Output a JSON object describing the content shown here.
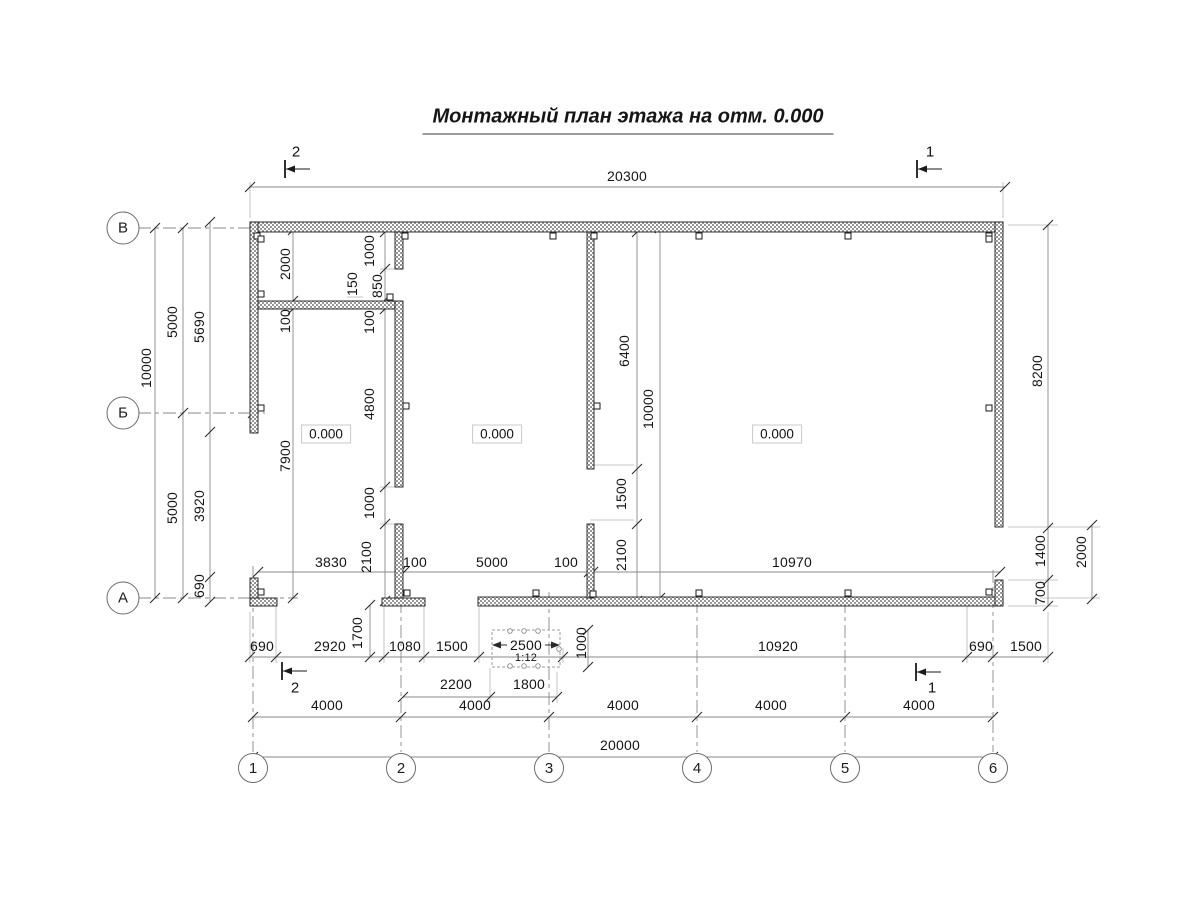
{
  "title": {
    "text": "Монтажный план этажа на отм. 0.000"
  },
  "colors": {
    "ink": "#141414",
    "dim_line": "#8a8a8a",
    "extension_line": "#b5b5b5",
    "grid_line": "#8a8a8a",
    "wall_hatch": "#969696",
    "background": "#ffffff"
  },
  "row_axes": [
    {
      "label": "В",
      "x": 123,
      "y": 228
    },
    {
      "label": "Б",
      "x": 123,
      "y": 413
    },
    {
      "label": "А",
      "x": 123,
      "y": 598
    }
  ],
  "col_axes": [
    {
      "label": "1",
      "x": 253,
      "y": 768
    },
    {
      "label": "2",
      "x": 401,
      "y": 768
    },
    {
      "label": "3",
      "x": 549,
      "y": 768
    },
    {
      "label": "4",
      "x": 697,
      "y": 768
    },
    {
      "label": "5",
      "x": 845,
      "y": 768
    },
    {
      "label": "6",
      "x": 993,
      "y": 768
    }
  ],
  "section_labels": [
    {
      "t": "2",
      "x": 296,
      "y": 152
    },
    {
      "t": "1",
      "x": 930,
      "y": 152
    },
    {
      "t": "2",
      "x": 295,
      "y": 688
    },
    {
      "t": "1",
      "x": 932,
      "y": 688
    }
  ],
  "level_marks": [
    {
      "t": "0.000",
      "x": 326,
      "y": 434
    },
    {
      "t": "0.000",
      "x": 497,
      "y": 434
    },
    {
      "t": "0.000",
      "x": 777,
      "y": 434
    }
  ],
  "ramp": {
    "dim": "2500",
    "slope": "1:12",
    "dim_x": 526,
    "dim_y": 645,
    "slope_x": 526,
    "slope_y": 658
  },
  "dim_labels": [
    {
      "t": "20300",
      "x": 627,
      "y": 176
    },
    {
      "t": "3830",
      "x": 331,
      "y": 562
    },
    {
      "t": "100",
      "x": 415,
      "y": 562
    },
    {
      "t": "5000",
      "x": 492,
      "y": 562
    },
    {
      "t": "100",
      "x": 566,
      "y": 562
    },
    {
      "t": "10970",
      "x": 792,
      "y": 562
    },
    {
      "t": "690",
      "x": 262,
      "y": 646
    },
    {
      "t": "2920",
      "x": 330,
      "y": 646
    },
    {
      "t": "1080",
      "x": 405,
      "y": 646
    },
    {
      "t": "1500",
      "x": 452,
      "y": 646
    },
    {
      "t": "10920",
      "x": 778,
      "y": 646
    },
    {
      "t": "690",
      "x": 981,
      "y": 646
    },
    {
      "t": "1500",
      "x": 1026,
      "y": 646
    },
    {
      "t": "2200",
      "x": 456,
      "y": 684
    },
    {
      "t": "1800",
      "x": 529,
      "y": 684
    },
    {
      "t": "4000",
      "x": 327,
      "y": 705
    },
    {
      "t": "4000",
      "x": 475,
      "y": 705
    },
    {
      "t": "4000",
      "x": 623,
      "y": 705
    },
    {
      "t": "4000",
      "x": 771,
      "y": 705
    },
    {
      "t": "4000",
      "x": 919,
      "y": 705
    },
    {
      "t": "20000",
      "x": 620,
      "y": 745
    },
    {
      "t": "10000",
      "x": 146,
      "y": 368,
      "r": 1
    },
    {
      "t": "5000",
      "x": 172,
      "y": 322,
      "r": 1
    },
    {
      "t": "5000",
      "x": 172,
      "y": 508,
      "r": 1
    },
    {
      "t": "5690",
      "x": 199,
      "y": 327,
      "r": 1
    },
    {
      "t": "3920",
      "x": 199,
      "y": 506,
      "r": 1
    },
    {
      "t": "690",
      "x": 199,
      "y": 586,
      "r": 1
    },
    {
      "t": "2000",
      "x": 285,
      "y": 264,
      "r": 1
    },
    {
      "t": "100",
      "x": 285,
      "y": 321,
      "r": 1
    },
    {
      "t": "7900",
      "x": 285,
      "y": 456,
      "r": 1
    },
    {
      "t": "1000",
      "x": 369,
      "y": 251,
      "r": 1
    },
    {
      "t": "850",
      "x": 377,
      "y": 286,
      "r": 1
    },
    {
      "t": "150",
      "x": 352,
      "y": 284,
      "r": 1
    },
    {
      "t": "100",
      "x": 369,
      "y": 322,
      "r": 1
    },
    {
      "t": "4800",
      "x": 369,
      "y": 404,
      "r": 1
    },
    {
      "t": "1000",
      "x": 369,
      "y": 503,
      "r": 1
    },
    {
      "t": "2100",
      "x": 366,
      "y": 557,
      "r": 1
    },
    {
      "t": "1700",
      "x": 357,
      "y": 633,
      "r": 1
    },
    {
      "t": "6400",
      "x": 624,
      "y": 351,
      "r": 1
    },
    {
      "t": "1500",
      "x": 621,
      "y": 494,
      "r": 1
    },
    {
      "t": "2100",
      "x": 621,
      "y": 555,
      "r": 1
    },
    {
      "t": "10000",
      "x": 648,
      "y": 409,
      "r": 1
    },
    {
      "t": "1000",
      "x": 581,
      "y": 643,
      "r": 1
    },
    {
      "t": "8200",
      "x": 1037,
      "y": 371,
      "r": 1
    },
    {
      "t": "1400",
      "x": 1040,
      "y": 551,
      "r": 1
    },
    {
      "t": "700",
      "x": 1040,
      "y": 593,
      "r": 1
    },
    {
      "t": "2000",
      "x": 1081,
      "y": 552,
      "r": 1
    }
  ]
}
